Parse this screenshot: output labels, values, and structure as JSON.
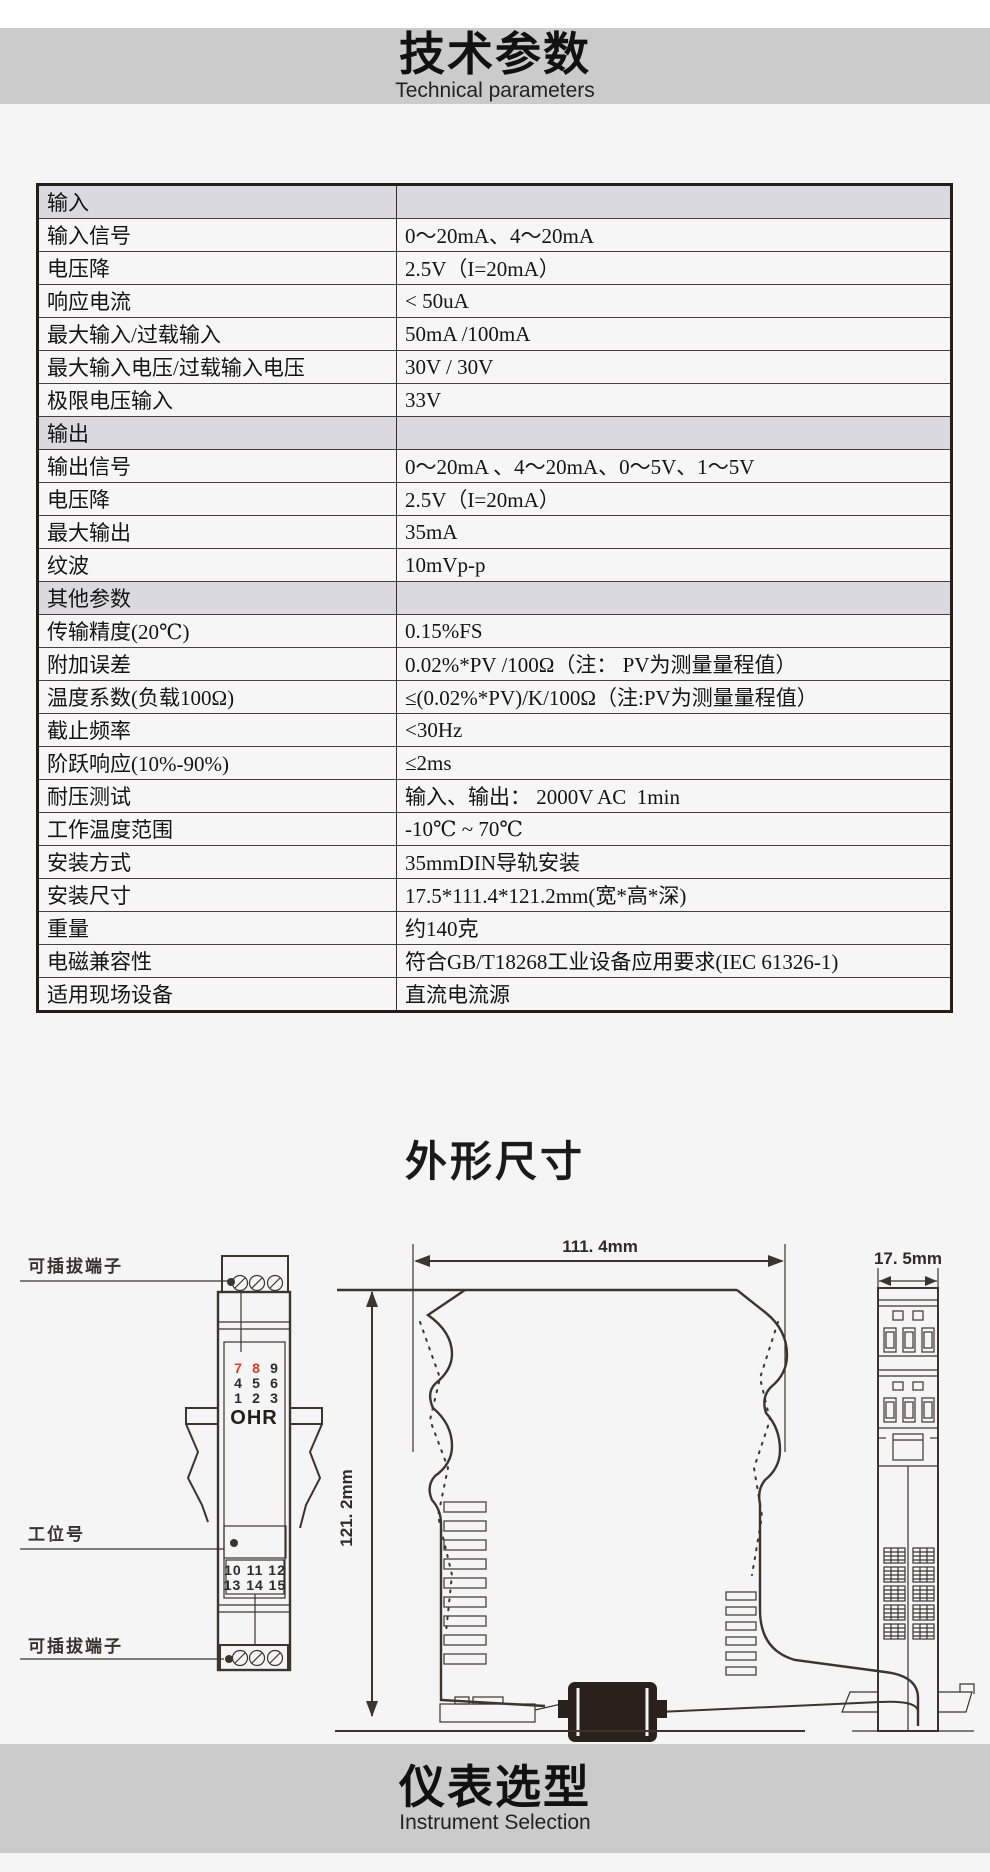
{
  "header": {
    "title": "技术参数",
    "subtitle": "Technical parameters"
  },
  "spec_table": {
    "rows": [
      {
        "type": "section",
        "label": "输入",
        "value": ""
      },
      {
        "type": "data",
        "label": "输入信号",
        "value": "0～20mA、4～20mA"
      },
      {
        "type": "data",
        "label": "电压降",
        "value": "2.5V（I=20mA）"
      },
      {
        "type": "data",
        "label": "响应电流",
        "value": "< 50uA"
      },
      {
        "type": "data",
        "label": "最大输入/过载输入",
        "value": "50mA /100mA"
      },
      {
        "type": "data",
        "label": "最大输入电压/过载输入电压",
        "value": "30V / 30V"
      },
      {
        "type": "data",
        "label": "极限电压输入",
        "value": "33V"
      },
      {
        "type": "section",
        "label": "输出",
        "value": ""
      },
      {
        "type": "data",
        "label": "输出信号",
        "value": "0～20mA 、4～20mA、0～5V、1～5V"
      },
      {
        "type": "data",
        "label": "电压降",
        "value": "2.5V（I=20mA）"
      },
      {
        "type": "data",
        "label": "最大输出",
        "value": "35mA"
      },
      {
        "type": "data",
        "label": "纹波",
        "value": "10mVp-p"
      },
      {
        "type": "section",
        "label": "其他参数",
        "value": ""
      },
      {
        "type": "data",
        "label": "传输精度(20℃)",
        "value": "0.15%FS"
      },
      {
        "type": "data",
        "label": "附加误差",
        "value": "0.02%*PV /100Ω（注： PV为测量量程值）"
      },
      {
        "type": "data",
        "label": "温度系数(负载100Ω)",
        "value": "≤(0.02%*PV)/K/100Ω（注:PV为测量量程值）"
      },
      {
        "type": "data",
        "label": "截止频率",
        "value": "<30Hz"
      },
      {
        "type": "data",
        "label": "阶跃响应(10%-90%)",
        "value": "≤2ms"
      },
      {
        "type": "data",
        "label": "耐压测试",
        "value": "输入、输出： 2000V AC  1min"
      },
      {
        "type": "data",
        "label": "工作温度范围",
        "value": "-10℃ ~ 70℃"
      },
      {
        "type": "data",
        "label": "安装方式",
        "value": "35mmDIN导轨安装"
      },
      {
        "type": "data",
        "label": "安装尺寸",
        "value": "17.5*111.4*121.2mm(宽*高*深)"
      },
      {
        "type": "data",
        "label": "重量",
        "value": "约140克"
      },
      {
        "type": "data",
        "label": "电磁兼容性",
        "value": "符合GB/T18268工业设备应用要求(IEC 61326-1)"
      },
      {
        "type": "data",
        "label": "适用现场设备",
        "value": "直流电流源"
      }
    ]
  },
  "outline_section": {
    "title": "外形尺寸"
  },
  "front_view": {
    "plug_terminal_top": "可插拔端子",
    "tag_label": "工位号",
    "plug_terminal_bottom": "可插拔端子",
    "logo": "OHR",
    "terminals_top": [
      "7",
      "8",
      "9",
      "4",
      "5",
      "6",
      "1",
      "2",
      "3"
    ],
    "terminals_bottom_row1": "10 11 12",
    "terminals_bottom_row2": "13 14 15"
  },
  "side_view": {
    "width_label": "111. 4mm",
    "height_label": "121. 2mm"
  },
  "top_view": {
    "width_label": "17. 5mm"
  },
  "footer": {
    "title": "仪表选型",
    "subtitle": "Instrument Selection"
  },
  "colors": {
    "band_gray": "#cbcbcb",
    "page_bg": "#f5f5f5",
    "section_row_bg": "#d9d9df",
    "table_border": "#241d18",
    "drawing_line": "#3c342d",
    "terminal_red": "#e8391d"
  }
}
